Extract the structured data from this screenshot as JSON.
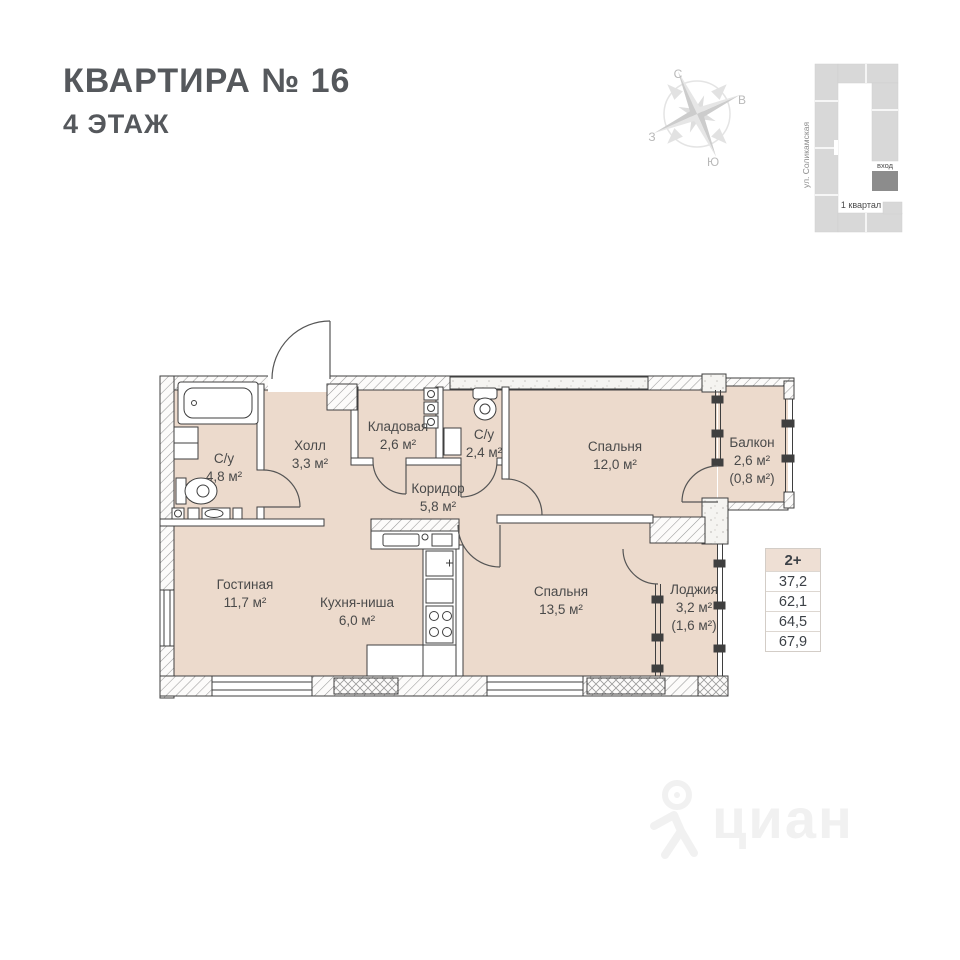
{
  "header": {
    "title": "КВАРТИРА № 16",
    "subtitle": "4 ЭТАЖ"
  },
  "compass": {
    "north": "С",
    "east": "В",
    "south": "Ю",
    "west": "З"
  },
  "site_plan": {
    "street": "ул. Соликамская",
    "entrance_label": "вход",
    "district_label": "1 квартал"
  },
  "plan": {
    "rooms": [
      {
        "name": "С/у",
        "area": "4,8 м²"
      },
      {
        "name": "Холл",
        "area": "3,3 м²"
      },
      {
        "name": "Кладовая",
        "area": "2,6 м²"
      },
      {
        "name": "С/у",
        "area": "2,4 м²"
      },
      {
        "name": "Спальня",
        "area": "12,0 м²"
      },
      {
        "name": "Балкон",
        "area": "2,6 м²",
        "area_reduced": "(0,8 м²)"
      },
      {
        "name": "Коридор",
        "area": "5,8 м²"
      },
      {
        "name": "Гостиная",
        "area": "11,7 м²"
      },
      {
        "name": "Кухня-ниша",
        "area": "6,0 м²"
      },
      {
        "name": "Спальня",
        "area": "13,5 м²"
      },
      {
        "name": "Лоджия",
        "area": "3,2 м²",
        "area_reduced": "(1,6 м²)"
      }
    ]
  },
  "summary_table": {
    "header": "2+",
    "rows": [
      "37,2",
      "62,1",
      "64,5",
      "67,9"
    ]
  },
  "watermark": {
    "text": "циан"
  },
  "colors": {
    "floor": "#ecdacc",
    "wall_line": "#3f3f3f",
    "table_header_bg": "#eedfd4",
    "title_text": "#55585c",
    "building_gray": "#d8d8d8",
    "entrance_gray": "#8c8c8c"
  }
}
